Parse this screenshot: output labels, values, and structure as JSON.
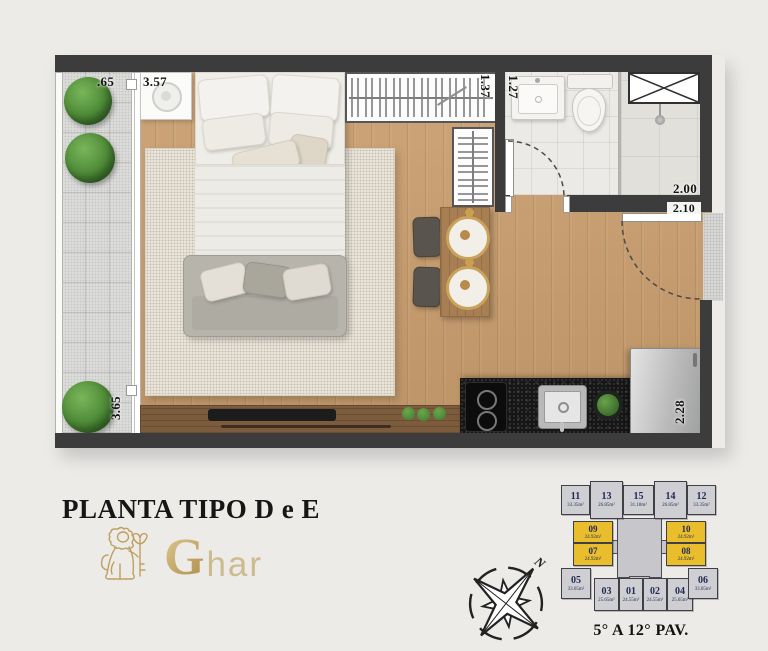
{
  "page": {
    "background": "#ecebe8"
  },
  "title": "PLANTA TIPO D e E",
  "logo": {
    "initial": "G",
    "rest": "har",
    "gold": "#bfa060"
  },
  "compass": {
    "north": "N"
  },
  "floor_plan": {
    "dimensions": {
      "balcony_width": ".65",
      "bedroom_width": "3.57",
      "closet_depth": "1.37",
      "bathroom_width": "1.27",
      "bathroom_length": "2.00",
      "entry_opening": "2.10",
      "kitchen_wall": "2.28",
      "balcony_length": "3.65"
    }
  },
  "key_plan": {
    "caption": "5° A 12° PAV.",
    "highlight_color": "#eabd2d",
    "unit_fill": "#cfcfd3",
    "units": [
      {
        "number": "11",
        "area": "33.35m²",
        "highlighted": false
      },
      {
        "number": "13",
        "area": "26.85m²",
        "highlighted": false
      },
      {
        "number": "15",
        "area": "31.18m²",
        "highlighted": false
      },
      {
        "number": "14",
        "area": "26.85m²",
        "highlighted": false
      },
      {
        "number": "12",
        "area": "33.35m²",
        "highlighted": false
      },
      {
        "number": "09",
        "area": "24.92m²",
        "highlighted": true
      },
      {
        "number": "10",
        "area": "24.92m²",
        "highlighted": true
      },
      {
        "number": "07",
        "area": "24.92m²",
        "highlighted": true
      },
      {
        "number": "08",
        "area": "24.92m²",
        "highlighted": true
      },
      {
        "number": "05",
        "area": "33.05m²",
        "highlighted": false
      },
      {
        "number": "03",
        "area": "25.65m²",
        "highlighted": false
      },
      {
        "number": "01",
        "area": "24.55m²",
        "highlighted": false
      },
      {
        "number": "02",
        "area": "24.55m²",
        "highlighted": false
      },
      {
        "number": "04",
        "area": "25.65m²",
        "highlighted": false
      },
      {
        "number": "06",
        "area": "33.05m²",
        "highlighted": false
      }
    ]
  }
}
